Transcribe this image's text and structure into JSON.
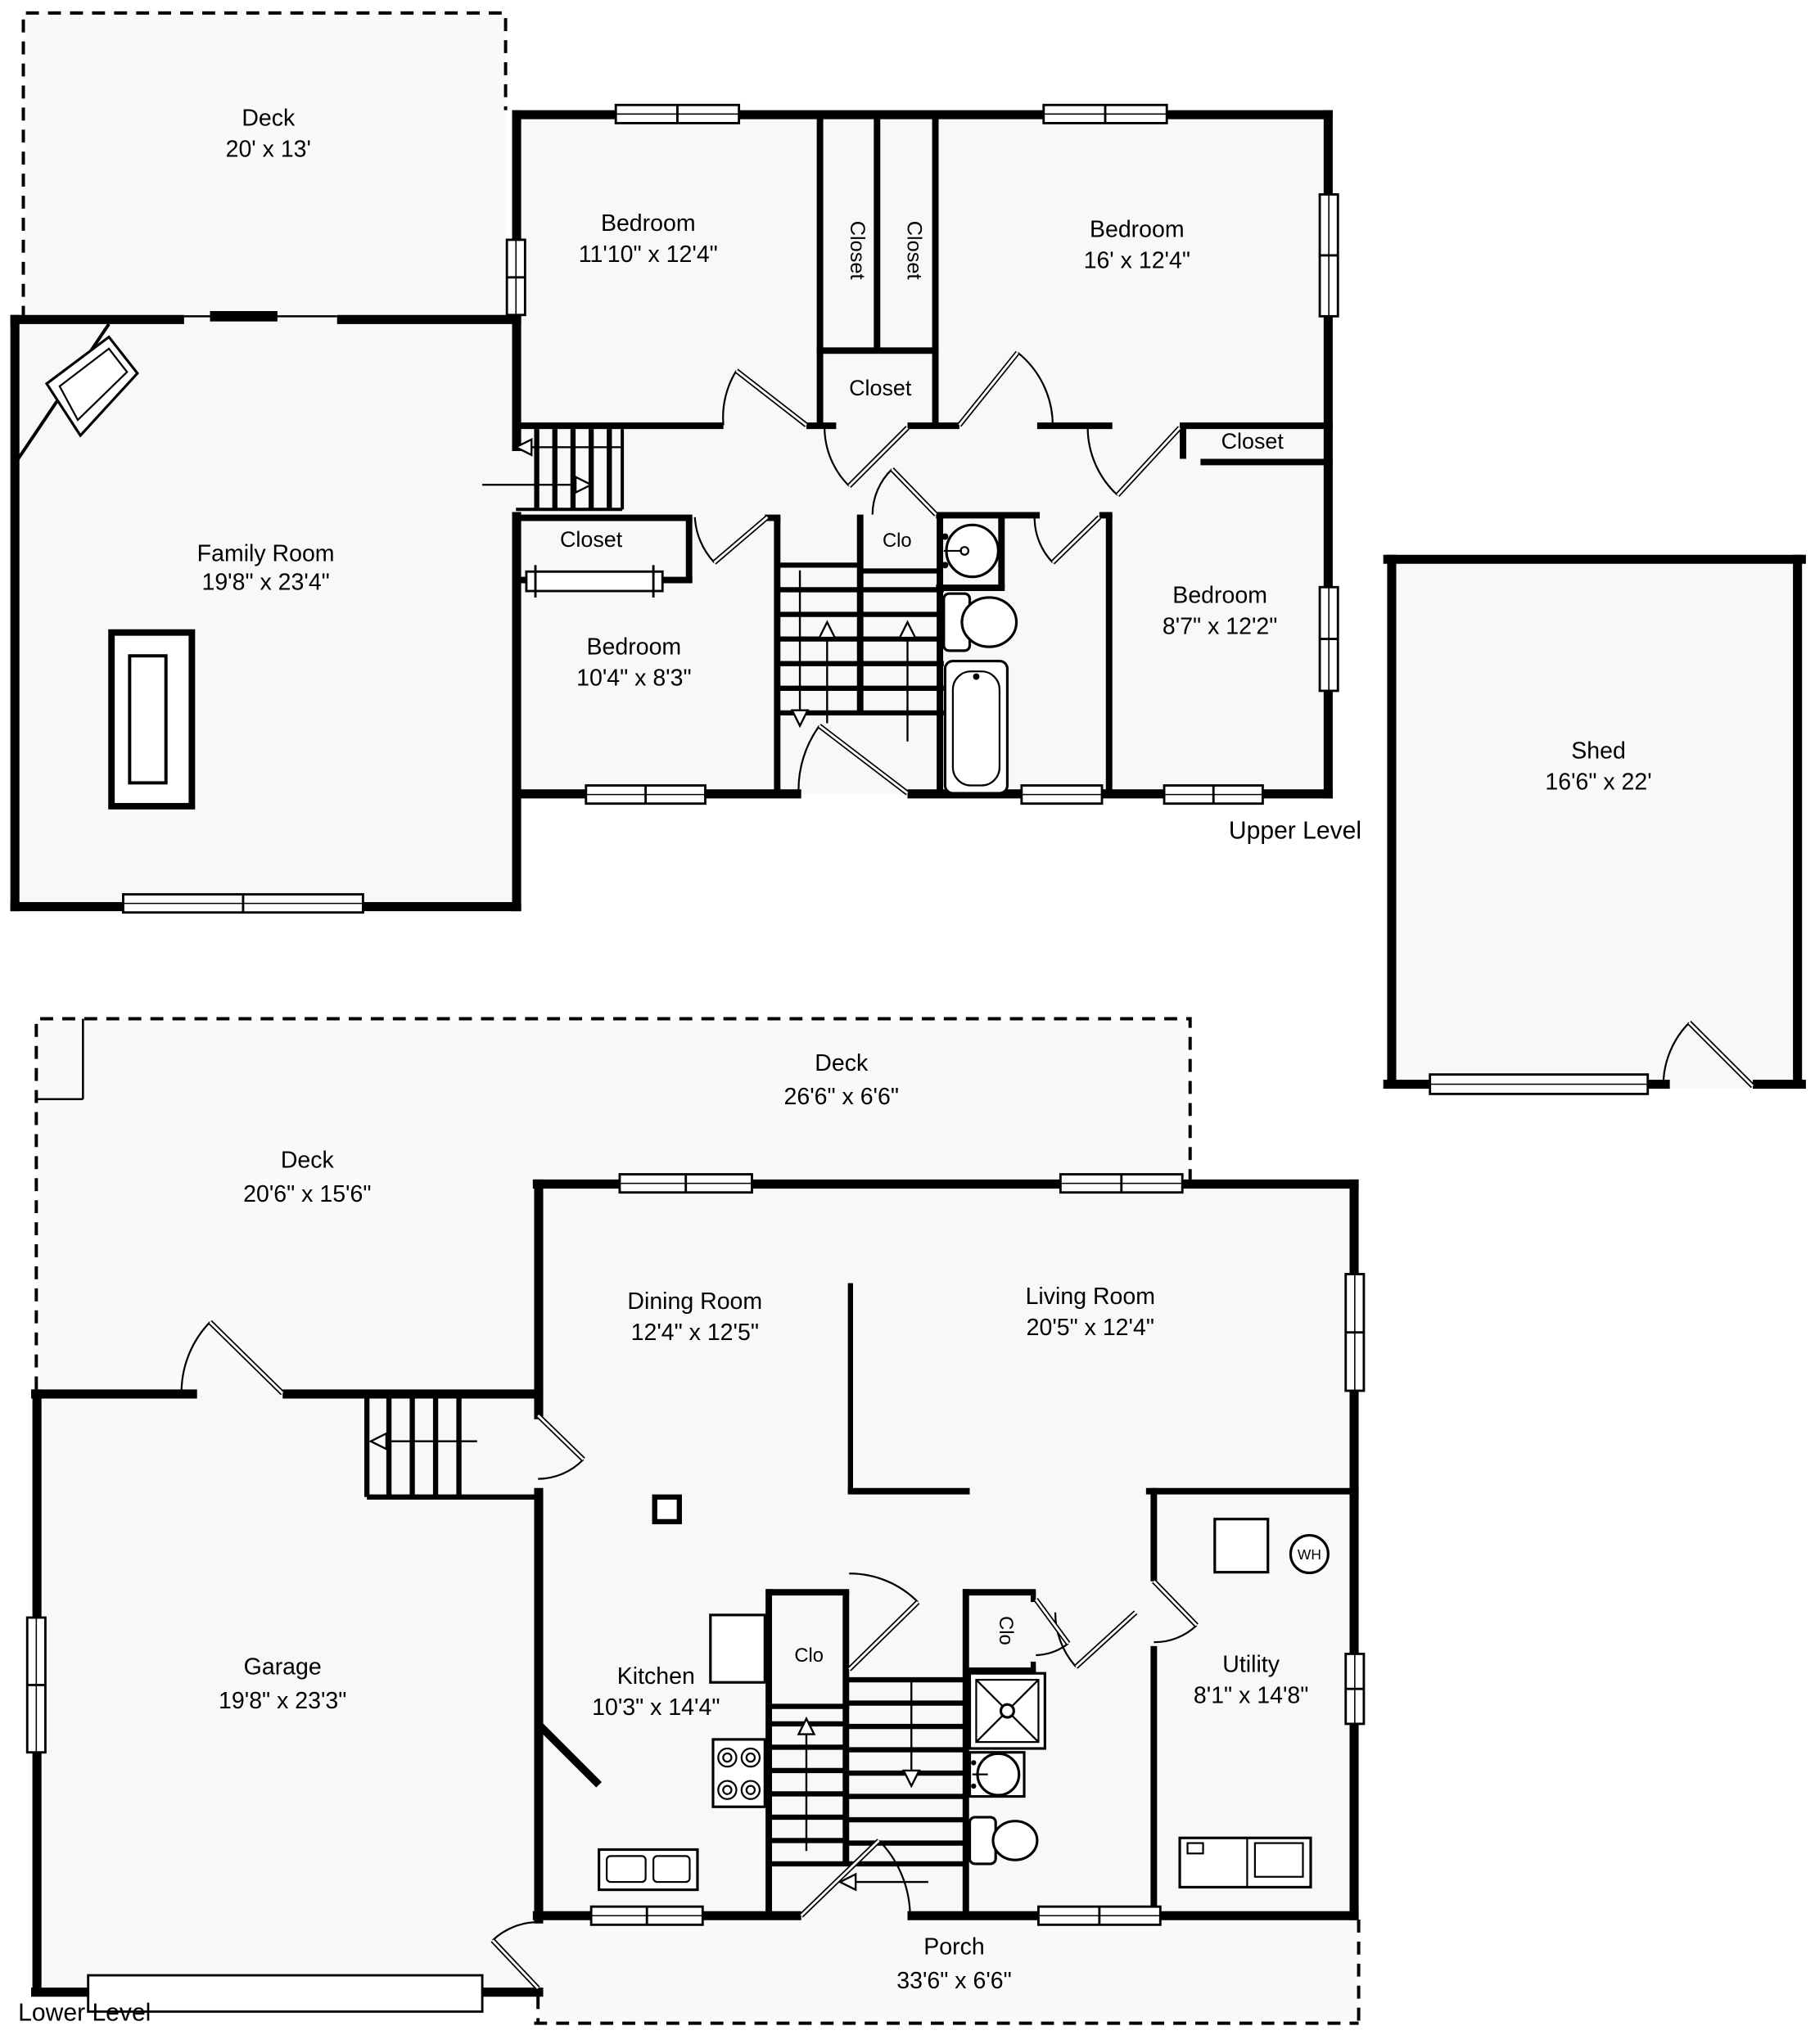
{
  "title": "Floor Plan",
  "levels": {
    "upper": "Upper Level",
    "lower": "Lower Level"
  },
  "labels": {
    "closet": "Closet",
    "clo": "Clo",
    "water_heater": "WH"
  },
  "rooms": {
    "deck_upper": {
      "name": "Deck",
      "dims": "20' x 13'"
    },
    "bedroom_front": {
      "name": "Bedroom",
      "dims": "11'10\" x 12'4\""
    },
    "bedroom_large": {
      "name": "Bedroom",
      "dims": "16' x 12'4\""
    },
    "family_room": {
      "name": "Family Room",
      "dims": "19'8\" x 23'4\""
    },
    "bedroom_small": {
      "name": "Bedroom",
      "dims": "10'4\" x 8'3\""
    },
    "bedroom_rear": {
      "name": "Bedroom",
      "dims": "8'7\" x 12'2\""
    },
    "shed": {
      "name": "Shed",
      "dims": "16'6\" x 22'"
    },
    "deck_rear": {
      "name": "Deck",
      "dims": "26'6\" x 6'6\""
    },
    "deck_side": {
      "name": "Deck",
      "dims": "20'6\" x 15'6\""
    },
    "dining_room": {
      "name": "Dining Room",
      "dims": "12'4\" x 12'5\""
    },
    "living_room": {
      "name": "Living Room",
      "dims": "20'5\" x 12'4\""
    },
    "garage": {
      "name": "Garage",
      "dims": "19'8\" x 23'3\""
    },
    "kitchen": {
      "name": "Kitchen",
      "dims": "10'3\" x 14'4\""
    },
    "utility": {
      "name": "Utility",
      "dims": "8'1\" x 14'8\""
    },
    "porch": {
      "name": "Porch",
      "dims": "33'6\" x 6'6\""
    }
  },
  "colors": {
    "wall": "#000000",
    "interior": "#f8f8f8",
    "background": "#ffffff"
  }
}
